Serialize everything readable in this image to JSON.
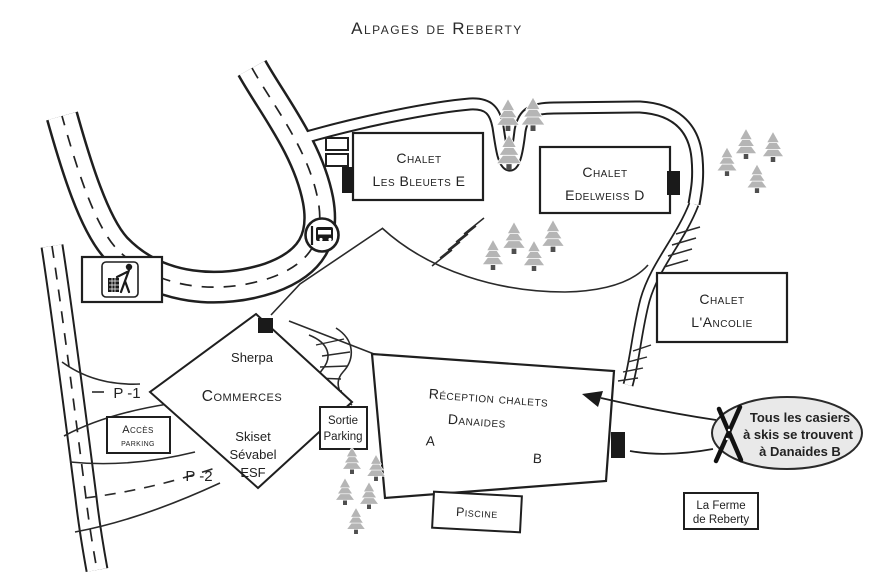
{
  "title": "Alpages de Reberty",
  "map": {
    "chalets": {
      "bleuets": {
        "line1": "Chalet",
        "line2": "Les Bleuets E"
      },
      "edelweiss": {
        "line1": "Chalet",
        "line2": "Edelweiss D"
      },
      "ancolie": {
        "line1": "Chalet",
        "line2": "L'Ancolie"
      }
    },
    "reception": {
      "line1": "Réception chalets",
      "line2": "Danaides",
      "wing_a": "A",
      "wing_b": "B"
    },
    "piscine": "Piscine",
    "ferme": {
      "line1": "La Ferme",
      "line2": "de Reberty"
    },
    "commerces": {
      "title": "Commerces",
      "shops": [
        "Sherpa",
        "Skiset",
        "Sévabel",
        "ESF"
      ]
    },
    "parking": {
      "acces_line1": "Accès",
      "acces_line2": "parking",
      "sortie_line1": "Sortie",
      "sortie_line2": "Parking",
      "p1": "P -1",
      "p2": "P -2"
    },
    "callout": {
      "line1": "Tous les casiers",
      "line2": "à skis se trouvent",
      "line3": "à Danaides B"
    }
  },
  "icons": {
    "bus_stop": "bus-stop-icon",
    "litter_bin": "litter-bin-icon",
    "crossed_skis": "crossed-skis-icon"
  },
  "colors": {
    "ink": "#1f1f1f",
    "tree_fill": "#b5b5b5",
    "tree_trunk": "#4f4f4f",
    "callout_fill": "#e9e9e9",
    "background": "#ffffff"
  }
}
